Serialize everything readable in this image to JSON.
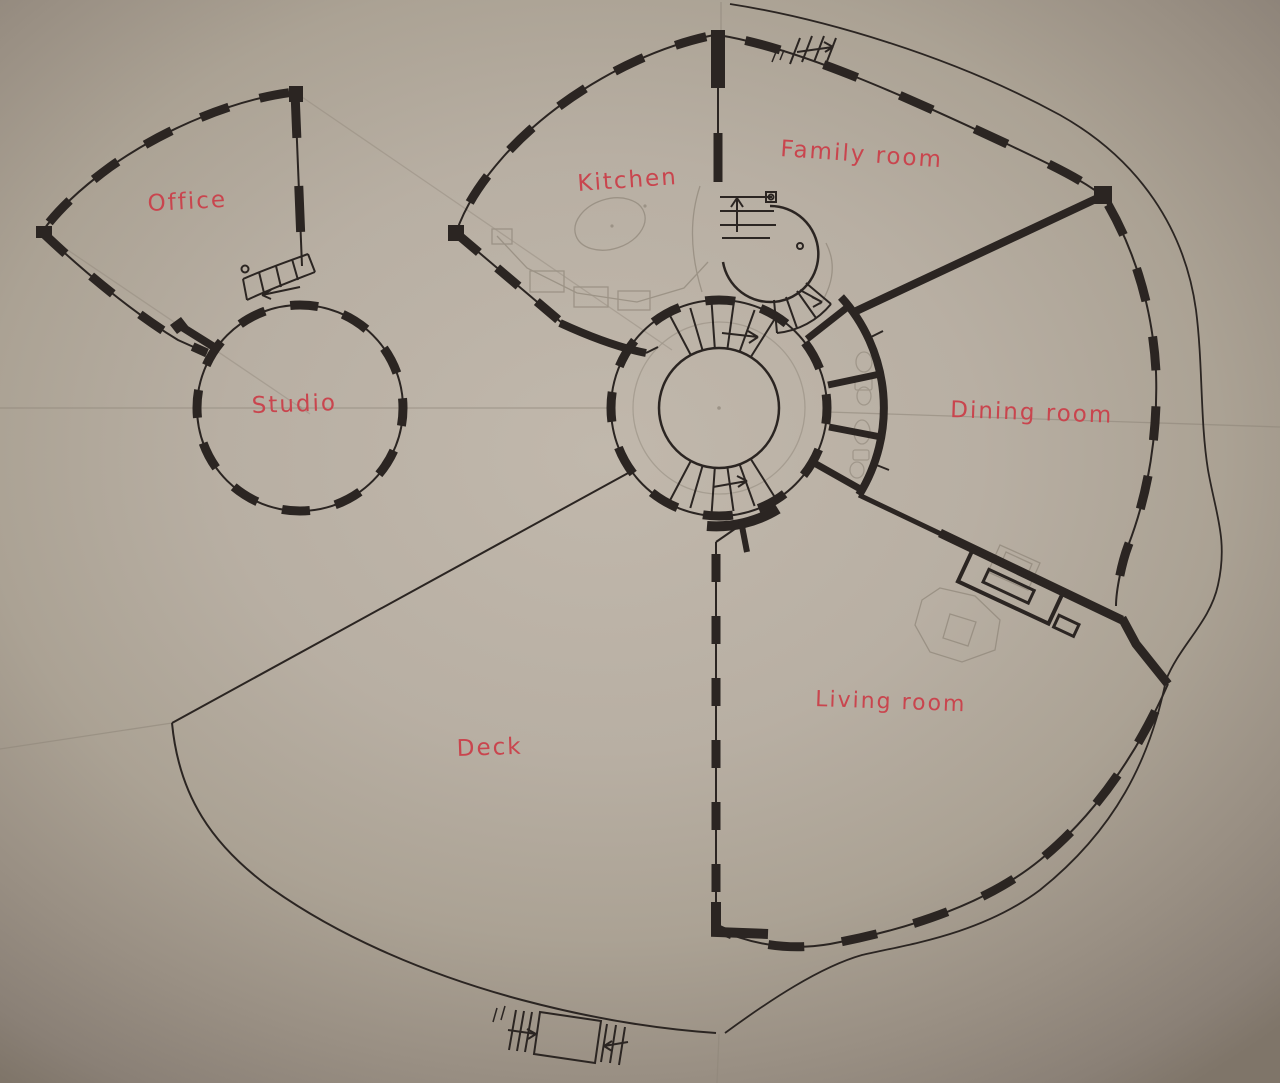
{
  "image": {
    "kind": "hand-drawn floor plan sketch (ink and pencil on photographed paper)"
  },
  "rooms": [
    {
      "id": "office",
      "label": "Office"
    },
    {
      "id": "studio",
      "label": "Studio"
    },
    {
      "id": "kitchen",
      "label": "Kitchen"
    },
    {
      "id": "family-room",
      "label": "Family room"
    },
    {
      "id": "dining-room",
      "label": "Dining room"
    },
    {
      "id": "living-room",
      "label": "Living room"
    },
    {
      "id": "deck",
      "label": "Deck"
    }
  ],
  "colors": {
    "ink": "#2b2522",
    "pencil": "#8f8679",
    "label_red": "#c9454e",
    "paper_light": "#c1b8ac",
    "paper_dark": "#7f7569"
  }
}
